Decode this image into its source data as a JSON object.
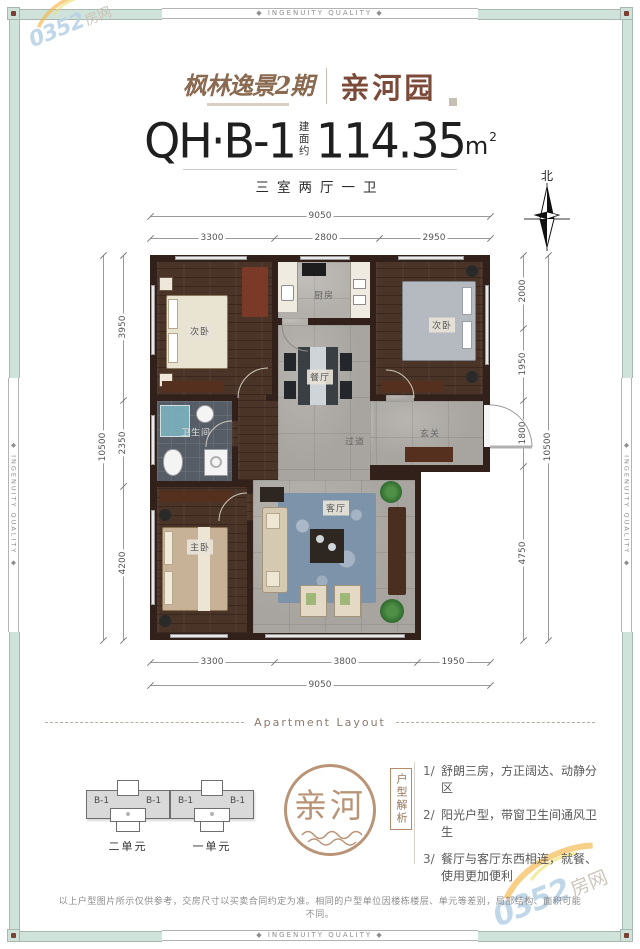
{
  "colors": {
    "mint": "#cfe3da",
    "frame_line": "#a9b7b1",
    "corner_dot": "#7a4034",
    "brand_brown": "#7c4a38",
    "logo_tan": "#8a6a50",
    "stamp_tan": "#b48c6c",
    "wall": "#31211a",
    "wood": "#4a3327",
    "tile": "#a8a5a0",
    "tile_dark": "#565d66",
    "rug": "#7d93aa",
    "wm_blue": "#b9d3e6",
    "wm_orange": "#f4b84e"
  },
  "frame": {
    "banner": "◆ INGENUITY QUALITY ◆"
  },
  "watermark": {
    "num": "0352",
    "cn": "房网"
  },
  "header": {
    "brand_primary": "枫林逸景2期",
    "brand_secondary": "亲河园"
  },
  "title": {
    "unit_code": "QH·B-1",
    "area_label": "建面约",
    "area_value": "114.35",
    "area_unit": "m",
    "area_sup": "2",
    "subtitle": "三室两厅一卫"
  },
  "compass": {
    "north": "北"
  },
  "floorplan": {
    "dims": {
      "top": {
        "total": "9050",
        "segs": [
          "3300",
          "2800",
          "2950"
        ]
      },
      "bottom": {
        "total": "9050",
        "segs": [
          "3300",
          "3800",
          "1950"
        ]
      },
      "left": {
        "total": "10500",
        "segs": [
          "3950",
          "2350",
          "4200"
        ]
      },
      "right": {
        "total": "10500",
        "segs": [
          "2000",
          "1950",
          "1800",
          "4750"
        ]
      }
    },
    "rooms": [
      {
        "label": "次卧"
      },
      {
        "label": "厨房"
      },
      {
        "label": "次卧"
      },
      {
        "label": "餐厅"
      },
      {
        "label": "卫生间"
      },
      {
        "label": "过道"
      },
      {
        "label": "玄关"
      },
      {
        "label": "主卧"
      },
      {
        "label": "客厅"
      }
    ]
  },
  "layout_section": {
    "title": "Apartment Layout",
    "units": [
      {
        "name": "二单元",
        "flats": [
          "B-1",
          "B-1"
        ]
      },
      {
        "name": "一单元",
        "flats": [
          "B-1",
          "B-1"
        ]
      }
    ],
    "stamp_text": "亲河",
    "analysis_label": "户型解析",
    "points": [
      {
        "num": "1/",
        "text": "舒朗三房，方正阔达、动静分区"
      },
      {
        "num": "2/",
        "text": "阳光户型，带窗卫生间通风卫生"
      },
      {
        "num": "3/",
        "text": "餐厅与客厅东西相连，就餐、使用更加便利"
      }
    ]
  },
  "disclaimer": {
    "text": "以上户型图片所示仅供参考，交房尺寸以买卖合同约定为准。相同的户型单位因楼栋楼层、单元等差别，局部结构、面积可能不同。"
  }
}
